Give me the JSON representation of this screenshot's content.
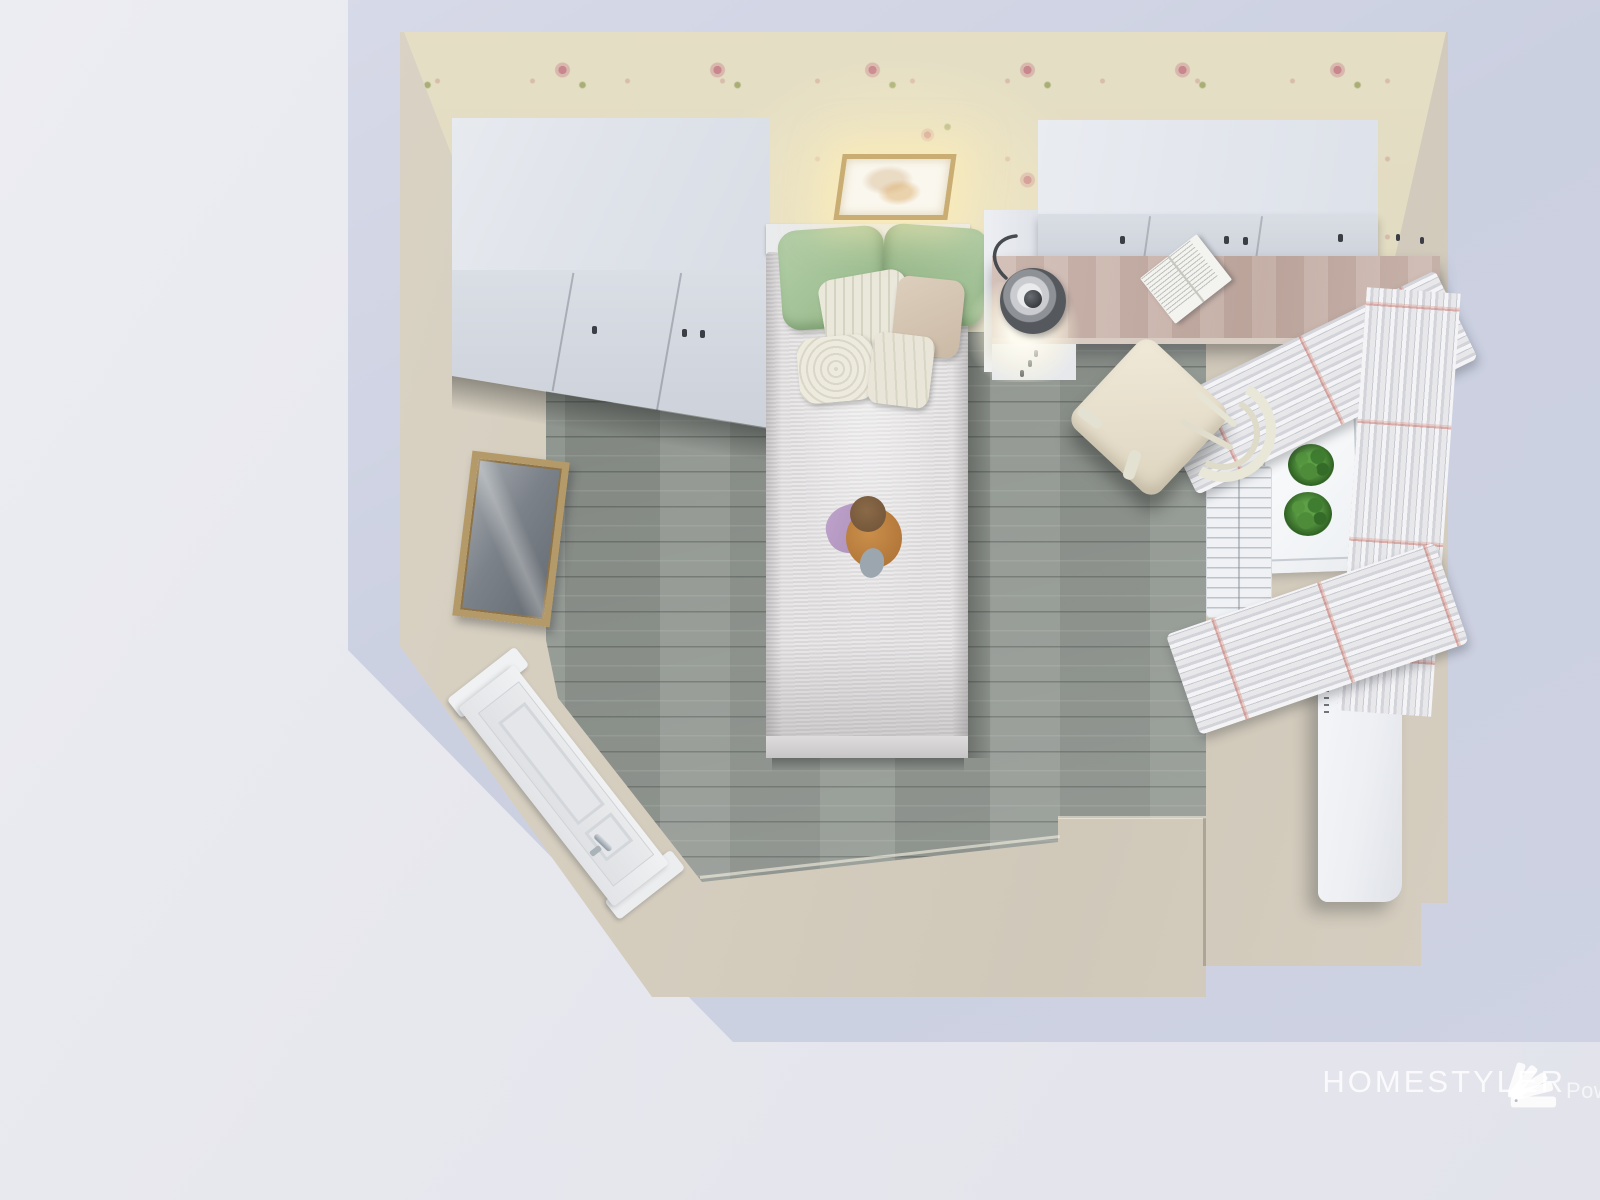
{
  "watermark": {
    "powered_by": "Powered by",
    "brand": "HOMESTYLER",
    "logo_icon": "homestyler-fan-logo"
  },
  "scene": {
    "type": "3d-floorplan-top-view-render",
    "room": "bedroom",
    "objects": [
      "floral-wallpaper-wall",
      "white-wardrobe",
      "single-bed",
      "green-pillows",
      "decor-pillows",
      "plush-doll",
      "ceiling-lamp",
      "overhead-cabinets",
      "desk",
      "desk-lamp",
      "open-book",
      "chair",
      "window",
      "potted-plants",
      "radiator",
      "ruffled-curtains",
      "tall-white-cabinet",
      "wall-tv",
      "interior-door",
      "gray-plank-floor",
      "entry-step"
    ],
    "colors": {
      "backdrop": "#e8e9ef",
      "outer_wall": "#ccd1e1",
      "walls": "#d7d0c2",
      "wallpaper": "#ebe5cc",
      "wallpaper_rose": "#cb828e",
      "floor": "#8f958f",
      "furniture_white": "#e6e9ee",
      "pillow_green": "#a3c298",
      "desk_wood": "#c9b3aa",
      "frame_gold": "#b49a68",
      "plant_green": "#47823a",
      "doll_purple": "#b69ac4"
    }
  }
}
